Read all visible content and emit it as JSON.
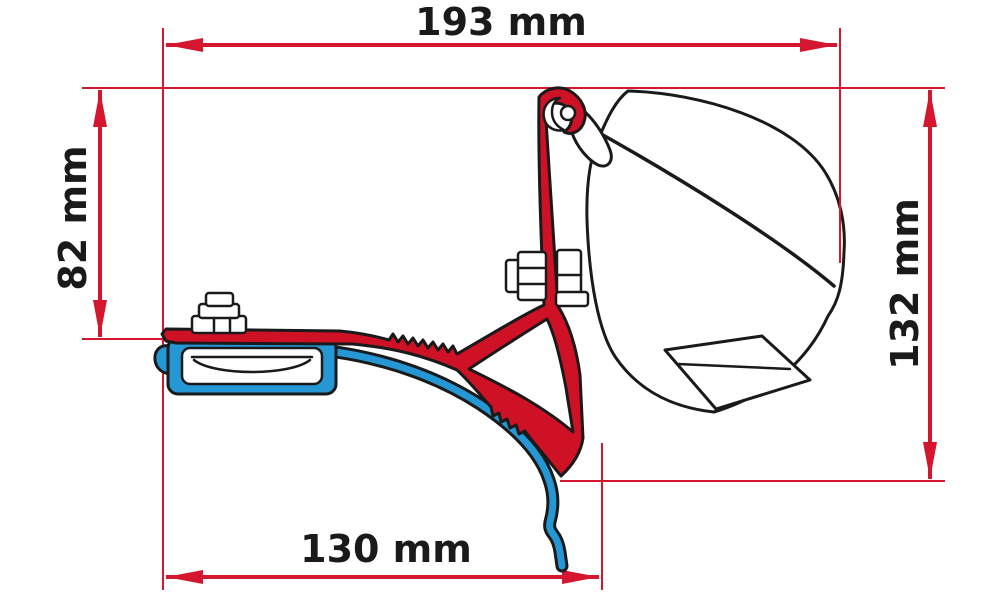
{
  "diagram": {
    "dimensions": {
      "top_width": {
        "label": "193 mm"
      },
      "left_height": {
        "label": "82 mm"
      },
      "right_height": {
        "label": "132 mm"
      },
      "bottom_width": {
        "label": "130 mm"
      }
    },
    "colors": {
      "background": "#ffffff",
      "dimension_red": "#d5162f",
      "adapter_red": "#cf1126",
      "rail_blue": "#2497d4",
      "case_white": "#ffffff",
      "outline": "#1a1a1a",
      "label_black": "#1a1a1a"
    }
  }
}
